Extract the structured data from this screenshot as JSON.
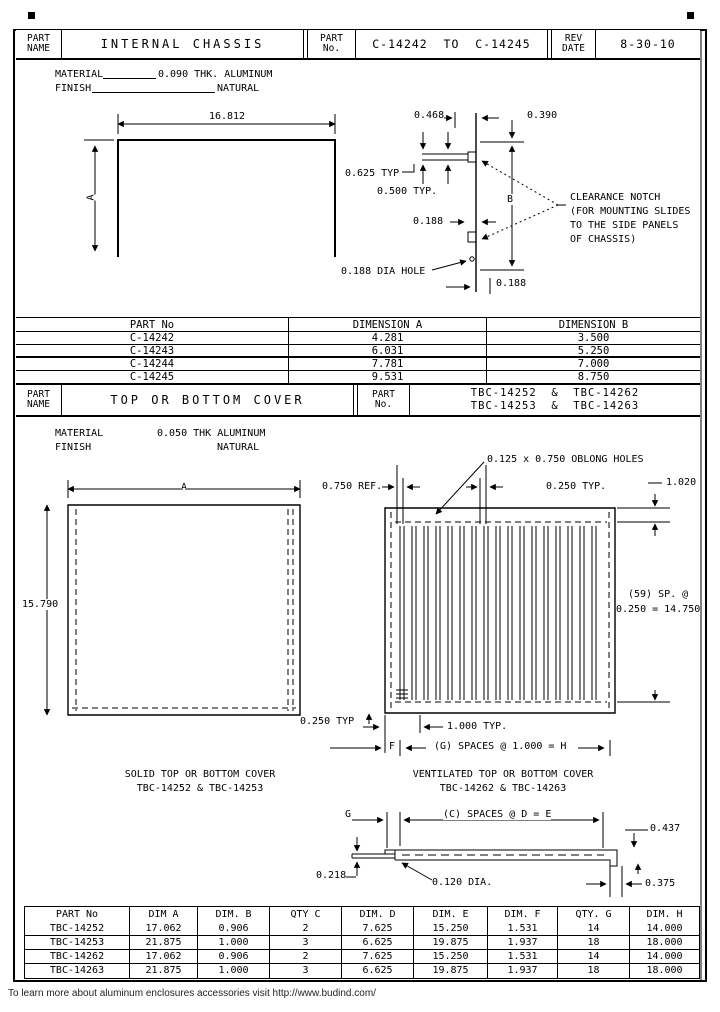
{
  "title_block_chassis": {
    "part_name_label_1": "PART",
    "part_name_label_2": "NAME",
    "part_name": "INTERNAL CHASSIS",
    "part_no_label_1": "PART",
    "part_no_label_2": "No.",
    "part_no": "C-14242  TO  C-14245",
    "rev_label_1": "REV",
    "rev_label_2": "DATE",
    "rev_date": "8-30-10"
  },
  "chassis": {
    "material_label": "MATERIAL",
    "material_value": "0.090 THK. ALUMINUM",
    "finish_label": "FINISH",
    "finish_value": "NATURAL",
    "dim_width": "16.812",
    "dim_height": "A",
    "dim_notch_width": "0.468",
    "dim_notch_top": "0.390",
    "dim_typ_625": "0.625 TYP",
    "dim_typ_500": "0.500 TYP.",
    "dim_b": "B",
    "dim_188": "0.188",
    "dim_hole": "0.188 DIA HOLE",
    "dim_bottom": "0.188",
    "note_line_1": "CLEARANCE NOTCH",
    "note_line_2": "(FOR MOUNTING SLIDES",
    "note_line_3": "TO THE SIDE PANELS",
    "note_line_4": "OF CHASSIS)"
  },
  "chassis_table": {
    "headers": [
      "PART No",
      "DIMENSION A",
      "DIMENSION B"
    ],
    "rows": [
      [
        "C-14242",
        "4.281",
        "3.500"
      ],
      [
        "C-14243",
        "6.031",
        "5.250"
      ],
      [
        "C-14244",
        "7.781",
        "7.000"
      ],
      [
        "C-14245",
        "9.531",
        "8.750"
      ]
    ]
  },
  "title_block_cover": {
    "part_name_label_1": "PART",
    "part_name_label_2": "NAME",
    "part_name": "TOP OR BOTTOM COVER",
    "part_no_label_1": "PART",
    "part_no_label_2": "No.",
    "part_no_line_1": "TBC-14252  &  TBC-14262",
    "part_no_line_2": "TBC-14253  &  TBC-14263"
  },
  "cover": {
    "material_label": "MATERIAL",
    "material_value": "0.050 THK ALUMINUM",
    "finish_label": "FINISH",
    "finish_value": "NATURAL",
    "oblong_note": "0.125 x 0.750 OBLONG HOLES",
    "dim_a": "A",
    "dim_750_ref": "0.750 REF.",
    "dim_250_typ_top": "0.250 TYP.",
    "dim_1020": "1.020",
    "dim_height": "15.790",
    "dim_sp_line_1": "(59) SP. @",
    "dim_sp_line_2": "0.250 = 14.750",
    "dim_250_typ_bottom": "0.250 TYP",
    "dim_1000_typ": "1.000 TYP.",
    "dim_f": "F",
    "dim_spaces_g": "(G) SPACES @ 1.000 = H",
    "solid_caption_1": "SOLID TOP OR BOTTOM COVER",
    "solid_caption_2": "TBC-14252 & TBC-14253",
    "vent_caption_1": "VENTILATED TOP OR BOTTOM COVER",
    "vent_caption_2": "TBC-14262 & TBC-14263"
  },
  "profile": {
    "dim_g": "G",
    "dim_spaces_c": "(C) SPACES @ D = E",
    "dim_437": "0.437",
    "dim_218": "0.218",
    "dim_120": "0.120 DIA.",
    "dim_375": "0.375"
  },
  "cover_table": {
    "headers": [
      "PART No",
      "DIM A",
      "DIM. B",
      "QTY C",
      "DIM. D",
      "DIM. E",
      "DIM. F",
      "QTY. G",
      "DIM. H"
    ],
    "rows": [
      [
        "TBC-14252",
        "17.062",
        "0.906",
        "2",
        "7.625",
        "15.250",
        "1.531",
        "14",
        "14.000"
      ],
      [
        "TBC-14253",
        "21.875",
        "1.000",
        "3",
        "6.625",
        "19.875",
        "1.937",
        "18",
        "18.000"
      ],
      [
        "TBC-14262",
        "17.062",
        "0.906",
        "2",
        "7.625",
        "15.250",
        "1.531",
        "14",
        "14.000"
      ],
      [
        "TBC-14263",
        "21.875",
        "1.000",
        "3",
        "6.625",
        "19.875",
        "1.937",
        "18",
        "18.000"
      ]
    ]
  },
  "footer": {
    "text": "To learn more about aluminum enclosures accessories visit http://www.budind.com/"
  }
}
